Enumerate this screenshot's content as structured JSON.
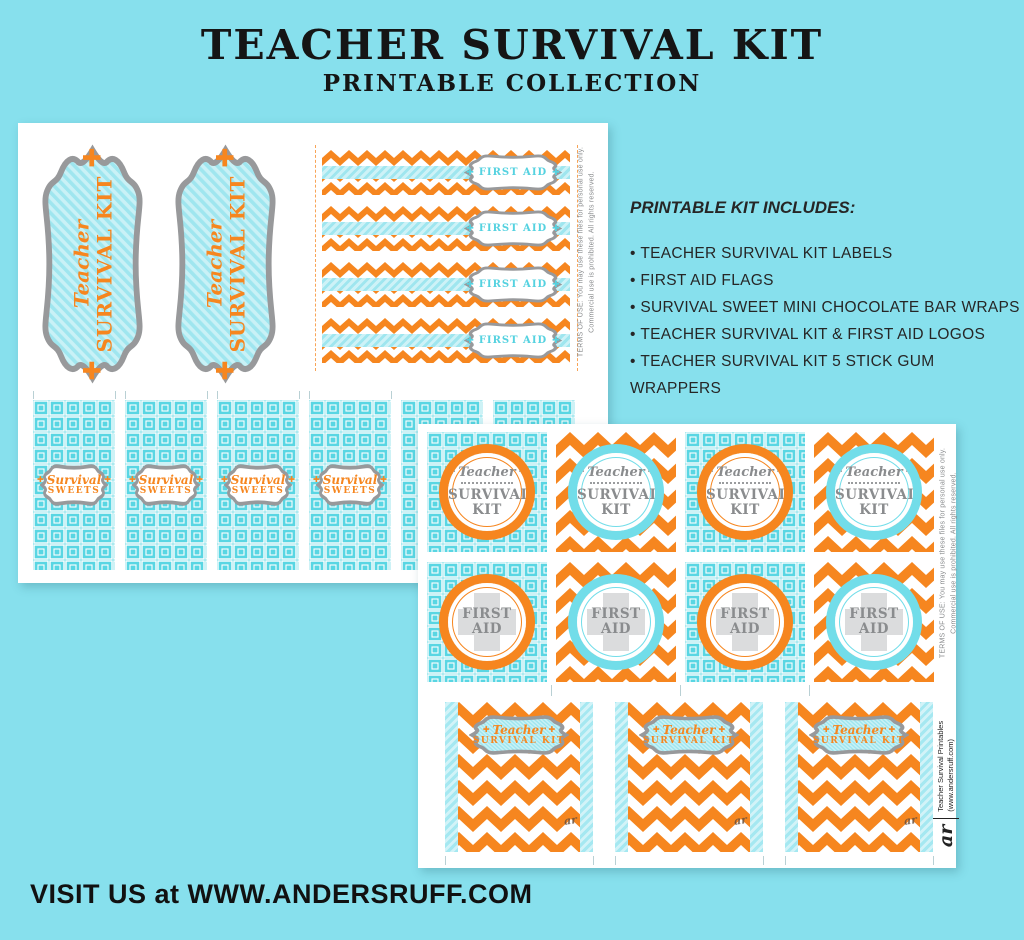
{
  "header": {
    "title": "TEACHER SURVIVAL KIT",
    "subtitle": "PRINTABLE COLLECTION"
  },
  "includes": {
    "heading": "PRINTABLE KIT INCLUDES:",
    "items": [
      "TEACHER SURVIVAL KIT LABELS",
      "FIRST AID FLAGS",
      "SURVIVAL SWEET MINI CHOCOLATE BAR WRAPS",
      "TEACHER SURVIVAL KIT & FIRST AID LOGOS",
      "TEACHER SURVIVAL KIT 5 STICK GUM WRAPPERS"
    ]
  },
  "labels": {
    "cross": "✚",
    "teacher": "Teacher",
    "survival_kit": "SURVIVAL KIT",
    "first_aid": "FIRST AID",
    "survival": "Survival",
    "sweets": "SWEETS"
  },
  "sheets": {
    "terms_line1": "TERMS OF USE: You may use these files for personal use only.",
    "terms_line2": "Commercial use is prohibited.  All rights reserved.",
    "credit_logo": "ar",
    "credit_line1": "Teacher Survival Printables",
    "credit_line2": "(www.andersruff.com)"
  },
  "footer": {
    "visit": "VISIT US at WWW.ANDERSRUFF.COM"
  },
  "colors": {
    "background": "#87E0ED",
    "orange": "#F6861F",
    "aqua_ring": "#72DDE9",
    "aqua_pattern": "#59D6E3",
    "gray_text": "#8A8C8E",
    "gray_border": "#98999B"
  }
}
